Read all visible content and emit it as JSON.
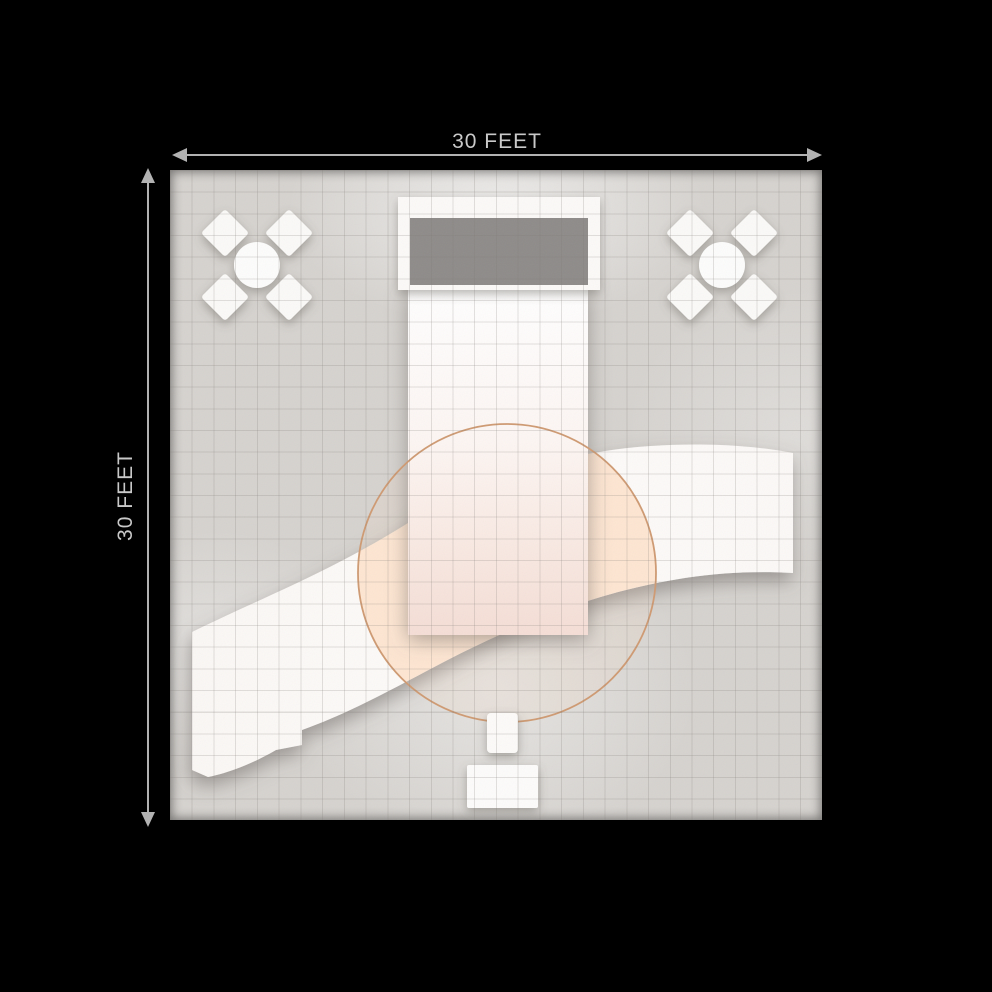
{
  "scene": {
    "title": "30 x 30 foot exhibit booth floor plan, top view"
  },
  "dimensions": {
    "top_label": "30 FEET",
    "left_label": "30 FEET"
  },
  "colors": {
    "page_background": "#000000",
    "floor": "#d6d3cf",
    "grid_line": "rgba(125,120,115,0.22)",
    "structure": "#fcfaf8",
    "header_panel": "#8e8b89",
    "accent_circle": "#cf9a72",
    "warm_glow": "#ffd9ba",
    "dimension_line": "#b2b2b2",
    "dimension_label": "#c9c9c9"
  },
  "furniture": {
    "seating_groups": [
      {
        "name": "seating-group-top-left",
        "table": "round table",
        "chairs": 4
      },
      {
        "name": "seating-group-top-right",
        "table": "round table",
        "chairs": 4
      }
    ],
    "structures": [
      "header wall with graphic panel",
      "center tower wall",
      "s-curved counter",
      "accent circle rug",
      "stool",
      "small table"
    ]
  }
}
